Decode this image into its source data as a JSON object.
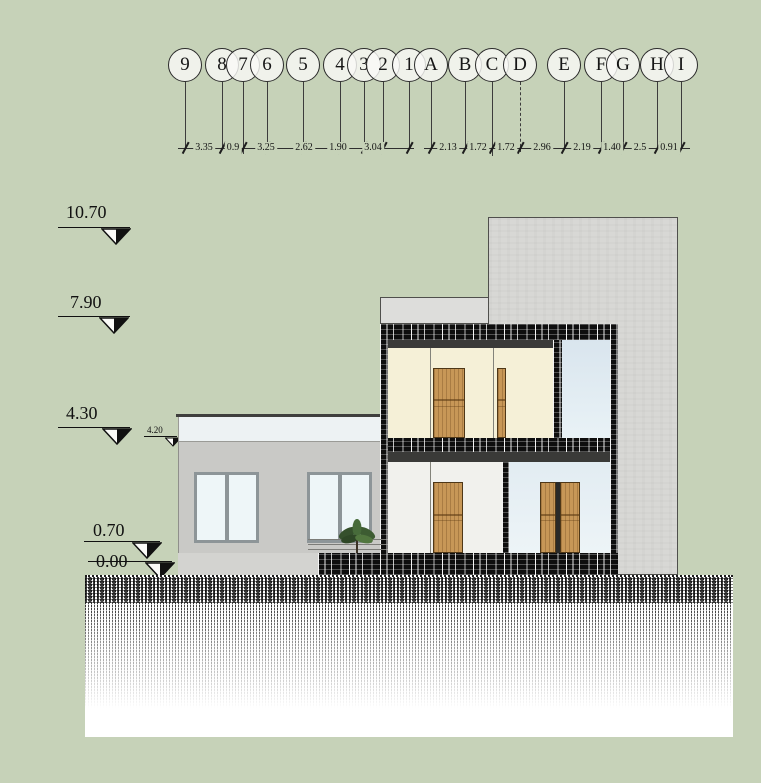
{
  "colors": {
    "background": "#c6d2b8",
    "concrete": "#d8d8d5",
    "wall_gray": "#c9c9c6",
    "cream_wall": "#f5f0d7",
    "glass_blue": "#dde8f0",
    "wood_door": "#c79757",
    "band_dark": "#0e0e0e",
    "ground": "#ffffff"
  },
  "grid": {
    "number_bubbles": [
      "9",
      "8",
      "7",
      "6",
      "5",
      "4",
      "3",
      "2",
      "1"
    ],
    "number_dims": [
      "3.35",
      "0.9",
      "3.25",
      "2.62",
      "1.90",
      "3.04"
    ],
    "letter_bubbles": [
      "A",
      "B",
      "C",
      "D",
      "E",
      "F",
      "G",
      "H",
      "I"
    ],
    "letter_dims": [
      "2.13",
      "1.72",
      "1.72",
      "2.96",
      "2.19",
      "1.40",
      "2.5",
      "0.91"
    ]
  },
  "levels": [
    "10.70",
    "7.90",
    "4.30",
    "4.20",
    "0.70",
    "0.00"
  ]
}
